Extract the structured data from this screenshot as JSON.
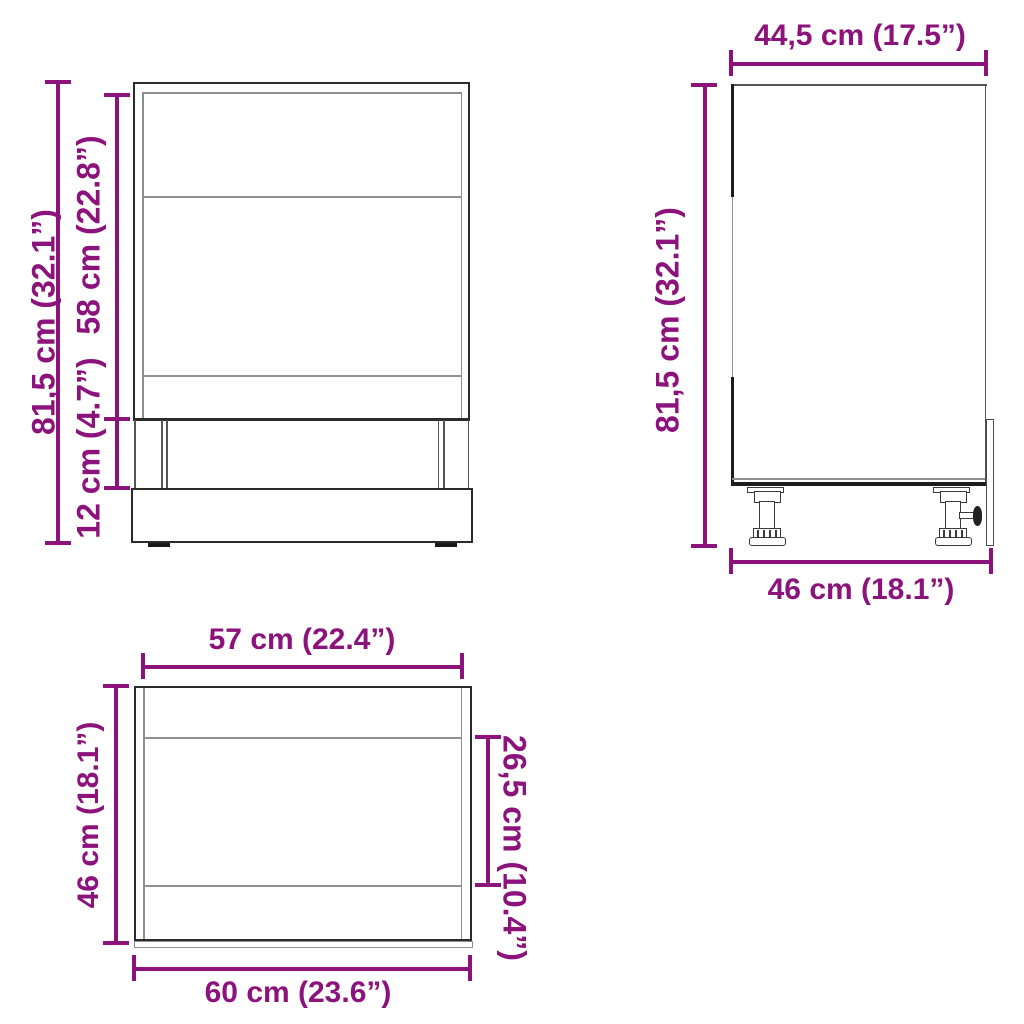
{
  "page": {
    "description": "Furniture dimension diagram with three orthographic line views of a kitchen base cabinet (front, side, top)",
    "background": "#ffffff"
  },
  "colors": {
    "dimension_text": "#8C127C",
    "outline_dark": "#2b2b2b",
    "outline_light": "#8f8f8f"
  },
  "views": {
    "front": {
      "name": "front-view",
      "dimensions": {
        "total_height": "81,5 cm (32.1”)",
        "body_height": "58 cm (22.8”)",
        "plinth_height": "12 cm (4.7”)"
      }
    },
    "side": {
      "name": "side-view",
      "dimensions": {
        "top_depth": "44,5 cm (17.5”)",
        "total_height": "81,5 cm (32.1”)",
        "bottom_depth": "46 cm (18.1”)"
      }
    },
    "top": {
      "name": "top-view",
      "dimensions": {
        "inner_width": "57 cm (22.4”)",
        "depth": "46 cm (18.1”)",
        "opening_depth": "26,5 cm (10.4”)",
        "outer_width": "60 cm (23.6”)"
      }
    }
  }
}
